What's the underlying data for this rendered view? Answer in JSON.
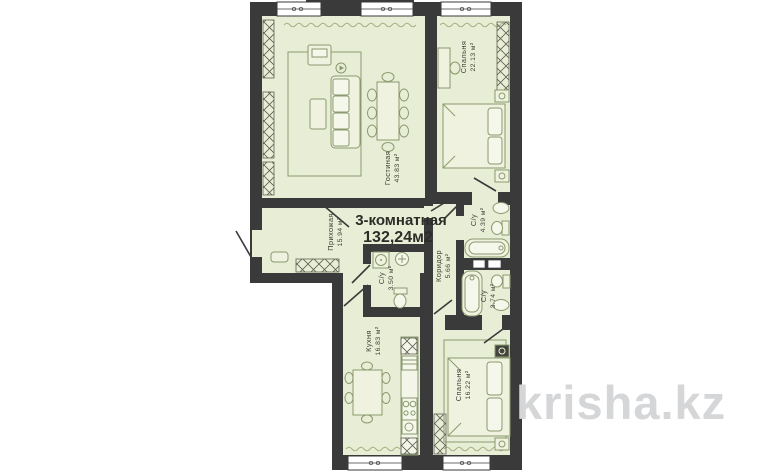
{
  "plan": {
    "title": {
      "line1": "3-комнатная",
      "line2": "132,24м2"
    },
    "rooms": [
      {
        "id": "living",
        "name": "Гостиная",
        "area": "43.83 м²"
      },
      {
        "id": "bedroom-top",
        "name": "Спальня",
        "area": "22.13 м²"
      },
      {
        "id": "hallway",
        "name": "Прихожая",
        "area": "15.94 м²"
      },
      {
        "id": "bathroom-top",
        "name": "С/у",
        "area": "4.39 м²"
      },
      {
        "id": "corridor",
        "name": "Коридор",
        "area": "5.66 м²"
      },
      {
        "id": "bathroom-mid",
        "name": "С/у",
        "area": "3.50 м²"
      },
      {
        "id": "bathroom-low",
        "name": "С/у",
        "area": "3.74 м²"
      },
      {
        "id": "kitchen",
        "name": "Кухня",
        "area": "16.83 м²"
      },
      {
        "id": "bedroom-bottom",
        "name": "Спальня",
        "area": "16.22 м²"
      }
    ],
    "colors": {
      "wall": "#3a3a3a",
      "room_fill": "#e8eed6",
      "furniture_line": "#8a996e",
      "watermark": "#d5d6d8"
    }
  },
  "watermark": {
    "text": "krisha.kz"
  }
}
